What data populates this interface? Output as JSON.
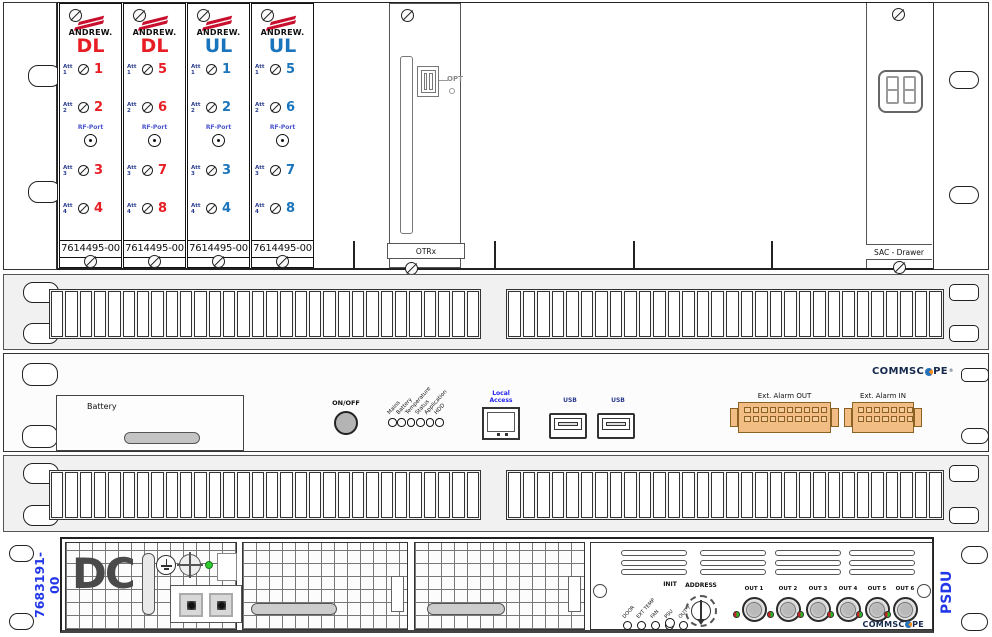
{
  "top_unit": {
    "cards": [
      {
        "brand": "ANDREW.",
        "type": "DL",
        "color_key": "red",
        "att_labels": [
          "Att 1",
          "Att 2",
          "Att 3",
          "Att 4"
        ],
        "ports": [
          "1",
          "2",
          "3",
          "4"
        ],
        "rf_label": "RF-Port",
        "part": "7614495-00"
      },
      {
        "brand": "ANDREW.",
        "type": "DL",
        "color_key": "red",
        "att_labels": [
          "Att 1",
          "Att 2",
          "Att 3",
          "Att 4"
        ],
        "ports": [
          "5",
          "6",
          "7",
          "8"
        ],
        "rf_label": "RF-Port",
        "part": "7614495-00"
      },
      {
        "brand": "ANDREW.",
        "type": "UL",
        "color_key": "blue",
        "att_labels": [
          "Att 1",
          "Att 2",
          "Att 3",
          "Att 4"
        ],
        "ports": [
          "1",
          "2",
          "3",
          "4"
        ],
        "rf_label": "RF-Port",
        "part": "7614495-00"
      },
      {
        "brand": "ANDREW.",
        "type": "UL",
        "color_key": "blue",
        "att_labels": [
          "Att 1",
          "Att 2",
          "Att 3",
          "Att 4"
        ],
        "ports": [
          "5",
          "6",
          "7",
          "8"
        ],
        "rf_label": "RF-Port",
        "part": "7614495-00"
      }
    ],
    "otrx": {
      "opt": "OPT",
      "label": "OTRx"
    },
    "sac_label": "SAC - Drawer",
    "display_digits": 2
  },
  "controller": {
    "battery": "Battery",
    "onoff": "ON/OFF",
    "leds": [
      "Mains",
      "Battery",
      "Temperature",
      "Status",
      "Application",
      "HDD"
    ],
    "local_access": [
      "Local",
      "Access"
    ],
    "usb": "USB",
    "alarm_out": "Ext. Alarm OUT",
    "alarm_in": "Ext. Alarm IN",
    "alarm_out_pins": {
      "rows": 2,
      "cols": 10
    },
    "alarm_in_pins": {
      "rows": 2,
      "cols": 7
    },
    "logo": "COMMSCOPE",
    "logo_reg": "®"
  },
  "psdu": {
    "part": "7683191-00",
    "dc": "DC",
    "leds": [
      "DOOR",
      "EXT TEMP",
      "FAN",
      "PSU",
      "OUT 7"
    ],
    "init": "INIT",
    "address": "ADDRESS",
    "outs": [
      "OUT 1",
      "OUT 2",
      "OUT 3",
      "OUT 4",
      "OUT 5",
      "OUT 6"
    ],
    "logo": "COMMSCOPE",
    "name": "PSDU"
  },
  "layout": {
    "grille_slats": 30,
    "vent_groups": 4,
    "vent_slots_per_group": 3
  },
  "colors": {
    "red": "#e81e25",
    "blue": "#1a75bc",
    "att_blue": "#2a3b8f",
    "rf_blue": "#4a55d2",
    "part_blue": "#2238e8",
    "orange": "#f2bd85",
    "orange_border": "#8a6224",
    "local_blue": "#2222ee",
    "logo_navy": "#15294d",
    "logo_orange": "#f68b1f",
    "logo_blue": "#2574bb",
    "green_led": "#2ecc2e"
  }
}
